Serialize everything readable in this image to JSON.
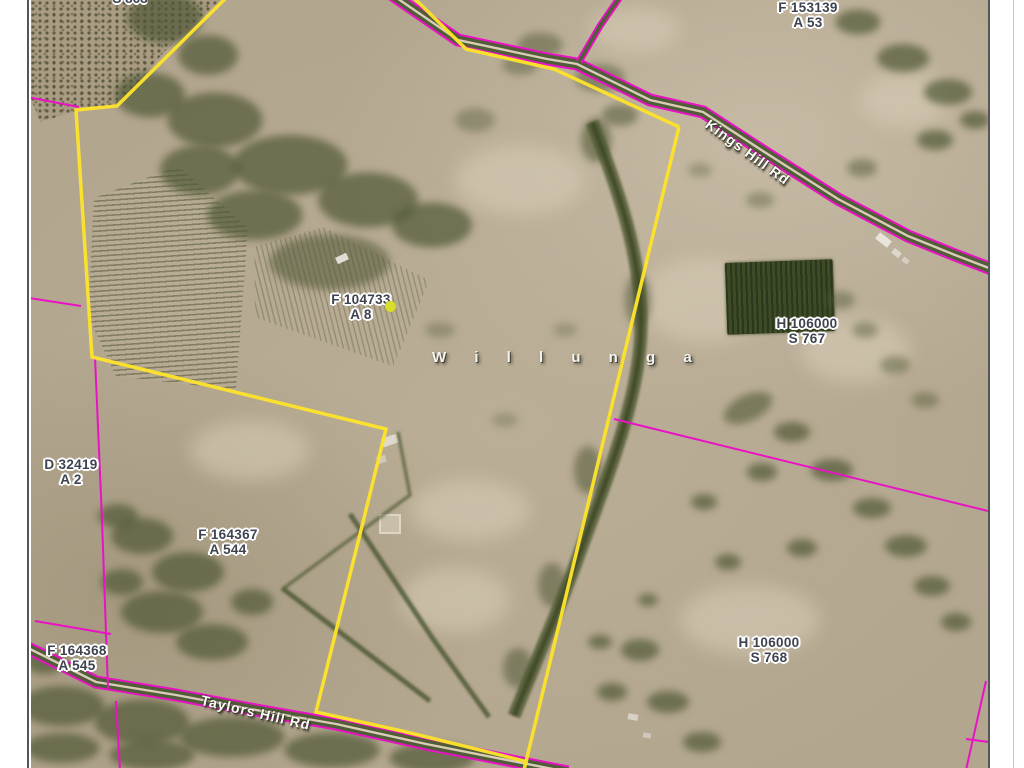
{
  "map_sheet": {
    "locality_label": "W i l l u n g a",
    "roads": [
      {
        "name": "Kings Hill Rd"
      },
      {
        "name": "Taylors Hill Rd"
      }
    ],
    "parcel_labels": [
      {
        "plan": "F 153139",
        "parcel": "A 53"
      },
      {
        "plan": "F 104733",
        "parcel": "A 8"
      },
      {
        "plan": "H 106000",
        "parcel": "S 767"
      },
      {
        "plan": "D 32419",
        "parcel": "A 2"
      },
      {
        "plan": "F 164367",
        "parcel": "A 544"
      },
      {
        "plan": "F 164368",
        "parcel": "A 545"
      },
      {
        "plan": "H 106000",
        "parcel": "S 768"
      }
    ],
    "truncated_top_label": "S 868",
    "colors": {
      "highlight_boundary": "#fce32b",
      "cadastral_line": "#e912c4",
      "terrain_base": "#b3a68f",
      "vegetation": "#4c5731",
      "parcel_label_text": "#3e4350",
      "parcel_label_halo": "#ffffff",
      "road_label_text": "#fdfdf8",
      "marker_dot": "#d7dd2b"
    }
  }
}
